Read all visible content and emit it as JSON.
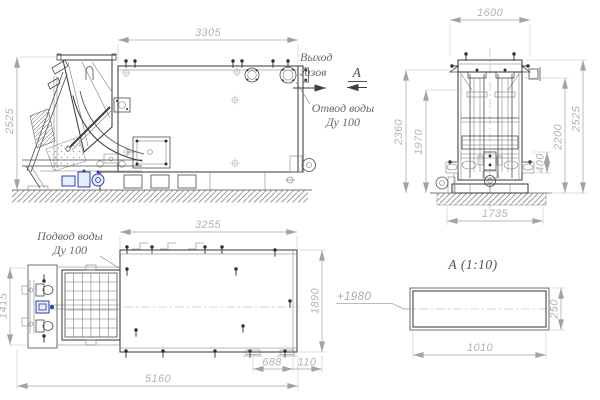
{
  "labels": {
    "gas_outlet": {
      "line1": "Выход",
      "line2": "газов"
    },
    "water_outlet": {
      "line1": "Отвод воды",
      "line2": "Ду 100"
    },
    "water_inlet": {
      "line1": "Подвод воды",
      "line2": "Ду 100"
    },
    "section_arrow_letter": "А",
    "section_title": "А  (1:10)",
    "elevation": "+1980"
  },
  "dims": {
    "side_width": "3305",
    "side_height": "2525",
    "front_width": "1600",
    "front_h_2360": "2360",
    "front_h_1970": "1970",
    "front_h_400": "400",
    "front_h_2200": "2200",
    "front_h_2525": "2525",
    "front_base": "1735",
    "plan_width": "3255",
    "plan_left": "1415",
    "plan_right": "1890",
    "plan_688": "688",
    "plan_110": "110",
    "plan_total": "5160",
    "section_h": "250",
    "section_w": "1010"
  },
  "colors": {
    "line": "#3d3d3d",
    "dim_line": "#a3a3a3",
    "dim_text": "#b3b3b3",
    "label_text": "#686868",
    "accent_blue": "#2b3cae",
    "hatch": "#8c8c8c",
    "background": "#ffffff"
  }
}
